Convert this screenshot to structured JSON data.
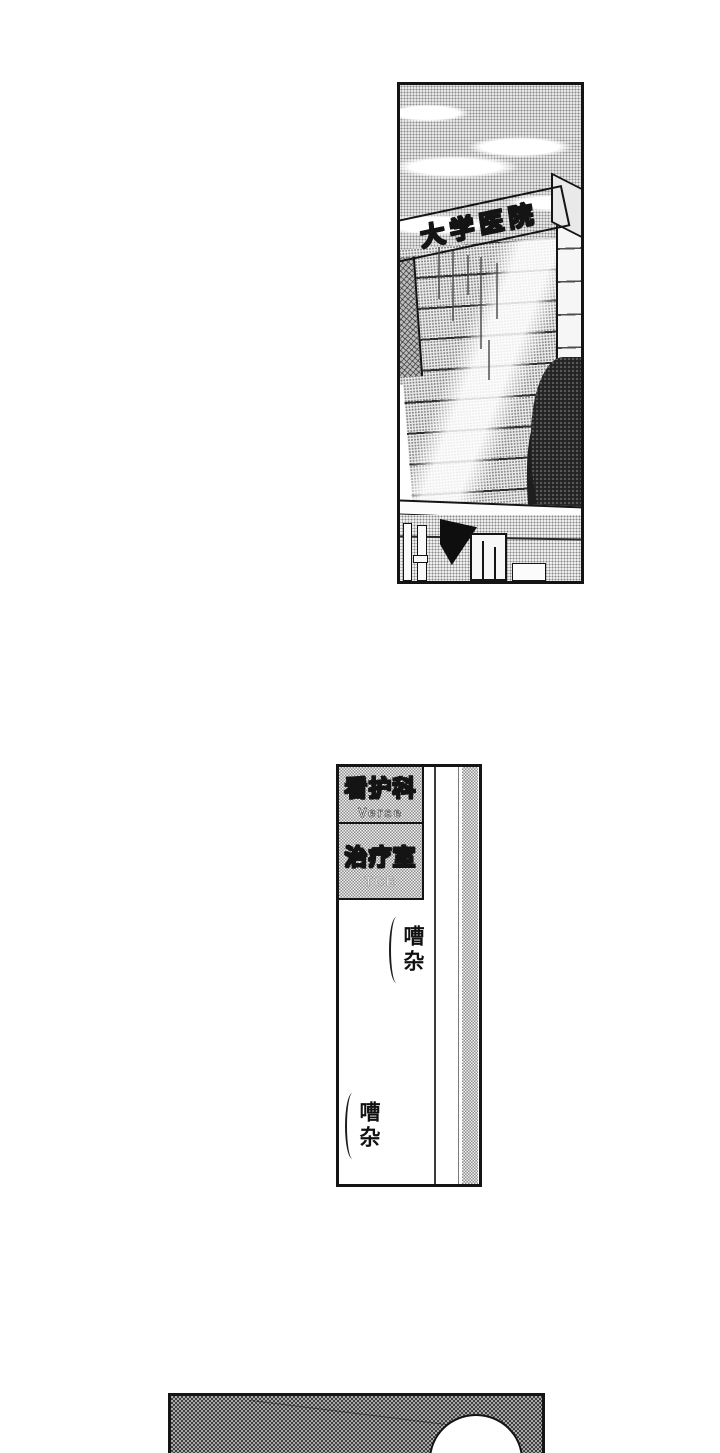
{
  "page": {
    "kind": "manga page",
    "colors": {
      "paper": "#ffffff",
      "ink": "#141414",
      "halftone_gray": "#8c8c8c"
    }
  },
  "hospital_panel": {
    "rooftop_sign": "大学医院"
  },
  "hallway_panel": {
    "signs": [
      {
        "label": "看护科",
        "sub": "Verse"
      },
      {
        "label": "治疗室",
        "sub": "TCE"
      }
    ],
    "sfx": [
      {
        "text": "嘈杂"
      },
      {
        "text": "嘈杂"
      }
    ]
  },
  "bottom_panel": {}
}
